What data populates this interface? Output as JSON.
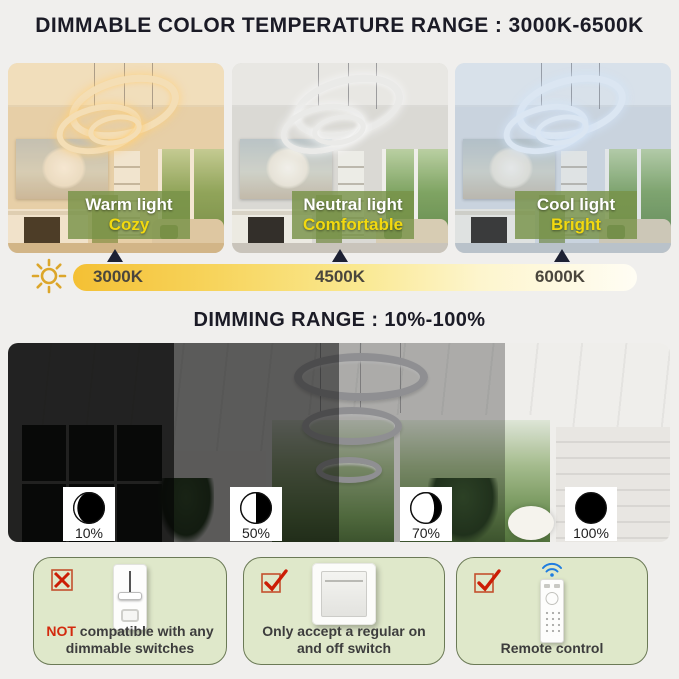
{
  "page": {
    "title_color_temp": "DIMMABLE COLOR TEMPERATURE RANGE : 3000K-6500K",
    "title_dimming": "DIMMING RANGE : 10%-100%"
  },
  "color_temp": {
    "modes": [
      {
        "name": "Warm light",
        "feel": "Cozy",
        "kelvin": "3000K"
      },
      {
        "name": "Neutral light",
        "feel": "Comfortable",
        "kelvin": "4500K"
      },
      {
        "name": "Cool light",
        "feel": "Bright",
        "kelvin": "6000K"
      }
    ]
  },
  "dimming": {
    "levels": [
      {
        "percent": "10%"
      },
      {
        "percent": "50%"
      },
      {
        "percent": "70%"
      },
      {
        "percent": "100%"
      }
    ]
  },
  "compatibility": {
    "items": [
      {
        "allowed": false,
        "prefix": "NOT",
        "text": " compatible with any dimmable switches"
      },
      {
        "allowed": true,
        "prefix": "",
        "text": "Only accept a regular on and off switch"
      },
      {
        "allowed": true,
        "prefix": "",
        "text": "Remote control"
      }
    ]
  },
  "colors": {
    "background": "#f0efed",
    "title_text": "#1b1b26",
    "label_overlay_green": "#7a9248",
    "label_feel_yellow": "#f2d90f",
    "bar_gold": "#f4c034",
    "box_green_bg": "#dfe8ca",
    "box_green_border": "#6b7a56",
    "status_red": "#d32a0e",
    "wifi_blue": "#1f7de0"
  }
}
